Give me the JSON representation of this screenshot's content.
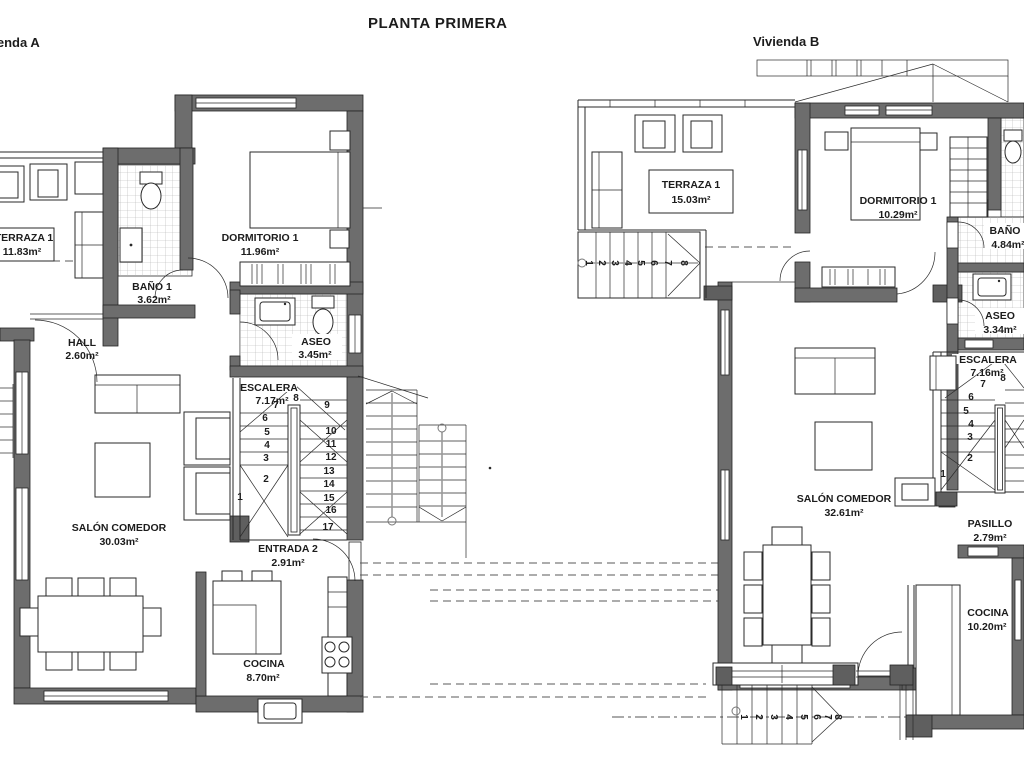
{
  "title": "PLANTA PRIMERA",
  "plan_a": {
    "name": "Vivienda A",
    "rooms": {
      "terraza": {
        "label": "TERRAZA 1",
        "area": "11.83m²"
      },
      "dormitorio": {
        "label": "DORMITORIO 1",
        "area": "11.96m²"
      },
      "bano": {
        "label": "BAÑO 1",
        "area": "3.62m²"
      },
      "hall": {
        "label": "HALL",
        "area": "2.60m²"
      },
      "aseo": {
        "label": "ASEO",
        "area": "3.45m²"
      },
      "escalera": {
        "label": "ESCALERA",
        "area": "7.17m²"
      },
      "salon": {
        "label": "SALÓN COMEDOR",
        "area": "30.03m²"
      },
      "entrada": {
        "label": "ENTRADA 2",
        "area": "2.91m²"
      },
      "cocina": {
        "label": "COCINA",
        "area": "8.70m²"
      }
    },
    "stair_steps": [
      "1",
      "2",
      "3",
      "4",
      "5",
      "6",
      "7",
      "8",
      "9",
      "10",
      "11",
      "12",
      "13",
      "14",
      "15",
      "16",
      "17"
    ]
  },
  "plan_b": {
    "name": "Vivienda B",
    "rooms": {
      "terraza": {
        "label": "TERRAZA 1",
        "area": "15.03m²"
      },
      "dormitorio": {
        "label": "DORMITORIO 1",
        "area": "10.29m²"
      },
      "bano": {
        "label": "BAÑO",
        "area": "4.84m²"
      },
      "aseo": {
        "label": "ASEO",
        "area": "3.34m²"
      },
      "escalera": {
        "label": "ESCALERA",
        "area": "7.16m²"
      },
      "salon": {
        "label": "SALÓN COMEDOR",
        "area": "32.61m²"
      },
      "pasillo": {
        "label": "PASILLO",
        "area": "2.79m²"
      },
      "cocina": {
        "label": "COCINA",
        "area": "10.20m²"
      }
    },
    "stair_steps": [
      "1",
      "2",
      "3",
      "4",
      "5",
      "6",
      "7",
      "8"
    ],
    "ext_stair_top_steps": [
      "1",
      "2",
      "3",
      "4",
      "5",
      "6",
      "7",
      "8"
    ],
    "ext_stair_bottom_steps": [
      "1",
      "2",
      "3",
      "4",
      "5",
      "6",
      "7",
      "8"
    ]
  },
  "colors": {
    "wall_fill": "#6d6d6d",
    "line": "#2a2a2a",
    "tile_line": "#b0b0b0"
  }
}
